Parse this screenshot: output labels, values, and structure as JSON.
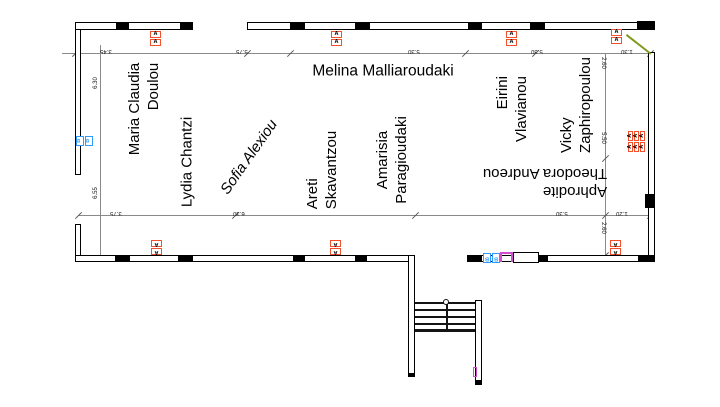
{
  "plan": {
    "type": "floor-plan",
    "names": [
      {
        "lines": [
          "Maria Claudia",
          "Doulou"
        ]
      },
      {
        "lines": [
          "Lydia Chantzi"
        ]
      },
      {
        "lines": [
          "Sofia Alexiou"
        ]
      },
      {
        "lines": [
          "Areti",
          "Skavantzou"
        ]
      },
      {
        "lines": [
          "Amarisia",
          "Paragioudaki"
        ]
      },
      {
        "lines": [
          "Melina Malliaroudaki"
        ]
      },
      {
        "lines": [
          "Eirini",
          "Vlavianou"
        ]
      },
      {
        "lines": [
          "Vicky",
          "Zaphiropoulou"
        ]
      },
      {
        "lines": [
          "Aphrodite",
          "Theodora Andreou"
        ]
      }
    ],
    "markers": {
      "window_label": "A",
      "door_label": "B"
    },
    "dims": {
      "top": [
        "3.45",
        "5.75",
        "5.30",
        "5.30",
        "1.30"
      ],
      "bottom": [
        "3.75",
        "6.30",
        "5.30",
        "1.20"
      ],
      "left": [
        "6.30",
        "6.55"
      ],
      "right": [
        "2.60",
        "5.50",
        "2.60"
      ]
    },
    "colors": {
      "wall": "#000000",
      "dimension_line": "#8a8a8a",
      "window_marker": "#f4502c",
      "door_marker": "#2e9bff",
      "magenta_accent": "#d24fd2",
      "door_swing": "#7f9a1e"
    }
  }
}
